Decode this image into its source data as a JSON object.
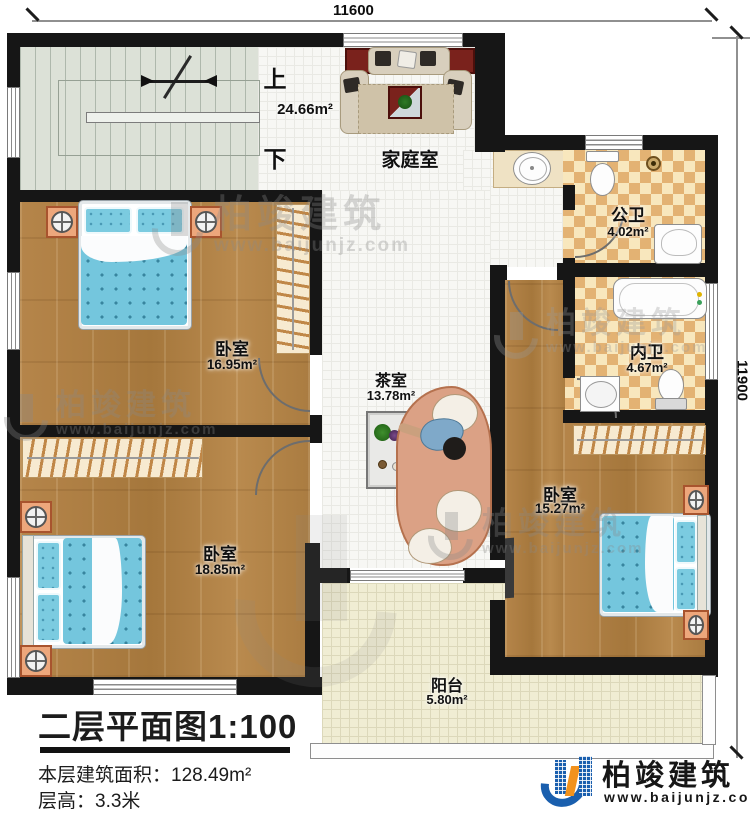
{
  "plan": {
    "dimensions": {
      "top": "11600",
      "right": "11900"
    },
    "stairs": {
      "up": "上",
      "down": "下"
    },
    "rooms": {
      "family": {
        "name": "家庭室",
        "area": "24.66m²"
      },
      "public_bath": {
        "name": "公卫",
        "area": "4.02m²"
      },
      "inner_bath": {
        "name": "内卫",
        "area": "4.67m²"
      },
      "bedroom_top_left": {
        "name": "卧室",
        "area": "16.95m²"
      },
      "tea_room": {
        "name": "茶室",
        "area": "13.78m²"
      },
      "bedroom_bottom_left": {
        "name": "卧室",
        "area": "18.85m²"
      },
      "bedroom_right": {
        "name": "卧室",
        "area": "15.27m²"
      },
      "balcony": {
        "name": "阳台",
        "area": "5.80m²"
      }
    }
  },
  "title_block": {
    "title": "二层平面图",
    "scale": "1:100",
    "area_label": "本层建筑面积：",
    "area_value": "128.49m²",
    "height_label": "层高：",
    "height_value": "3.3米"
  },
  "branding": {
    "name": "柏竣建筑",
    "url": "www.baijunjz.com"
  },
  "watermark": {
    "name": "柏竣建筑",
    "url": "www.baijunjz.com"
  },
  "colors": {
    "wall": "#161616",
    "wood_floor": "#b1813f",
    "checker_tan": "#e3b273",
    "checker_cream": "#f8e7bd",
    "bed_blue": "#74c6dd",
    "balcony_floor": "#f0edd3",
    "stair_floor": "#dce1d7",
    "logo_blue": "#1a5fae",
    "logo_orange": "#f2921d"
  }
}
